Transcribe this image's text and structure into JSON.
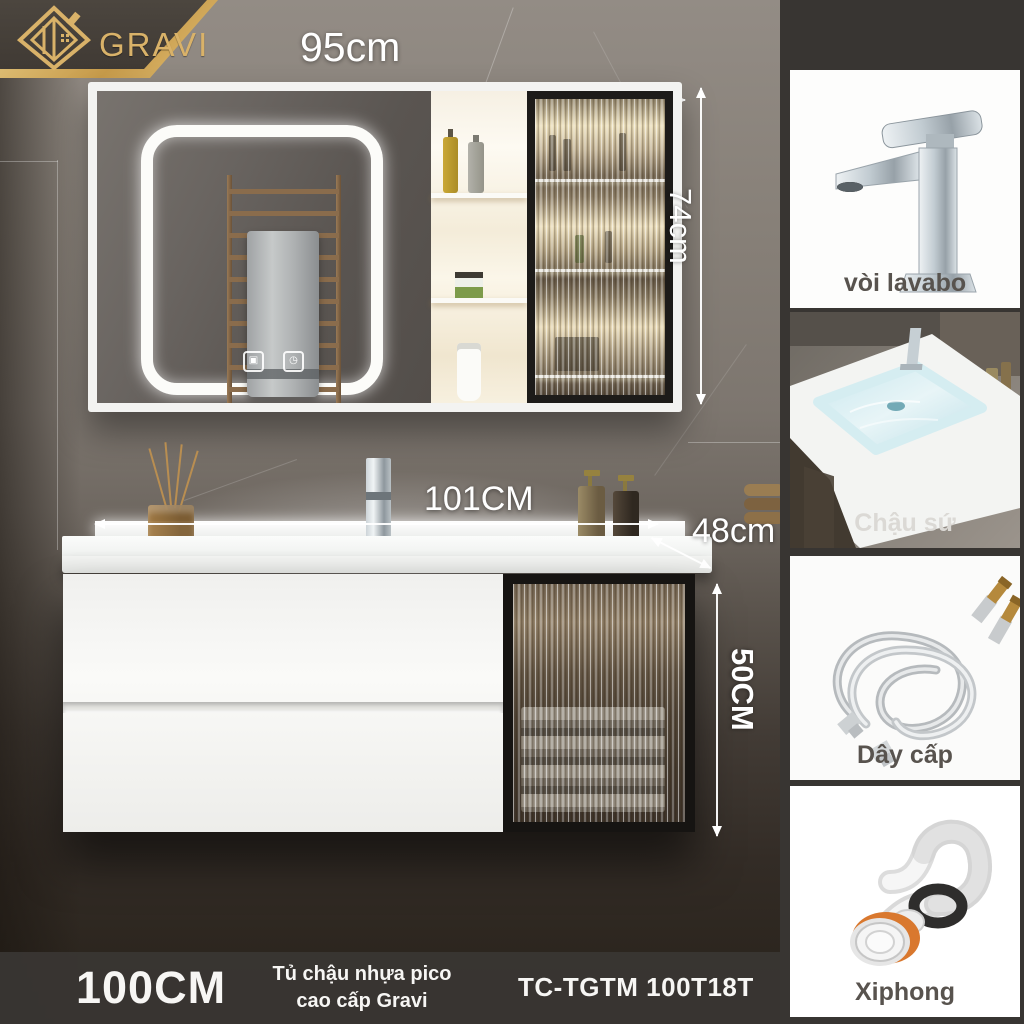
{
  "brand": {
    "name": "GRAVI",
    "gold_color": "#d9b269",
    "banner_color": "#45403a"
  },
  "icons": {
    "mirror_touch_defog": "▣",
    "mirror_touch_power": "◷"
  },
  "dimensions": {
    "mirror_width": "95cm",
    "mirror_height": "74cm",
    "basin_width": "101CM",
    "counter_depth": "48cm",
    "cabinet_height": "50CM"
  },
  "sidebar": {
    "items": [
      {
        "label": "vòi lavabo"
      },
      {
        "label": "Chậu sứ"
      },
      {
        "label": "Dây cấp"
      },
      {
        "label": "Xiphong"
      }
    ]
  },
  "footer": {
    "size": "100CM",
    "product_line1": "Tủ chậu nhựa pico",
    "product_line2": "cao cấp Gravi",
    "model": "TC-TGTM 100T18T"
  }
}
